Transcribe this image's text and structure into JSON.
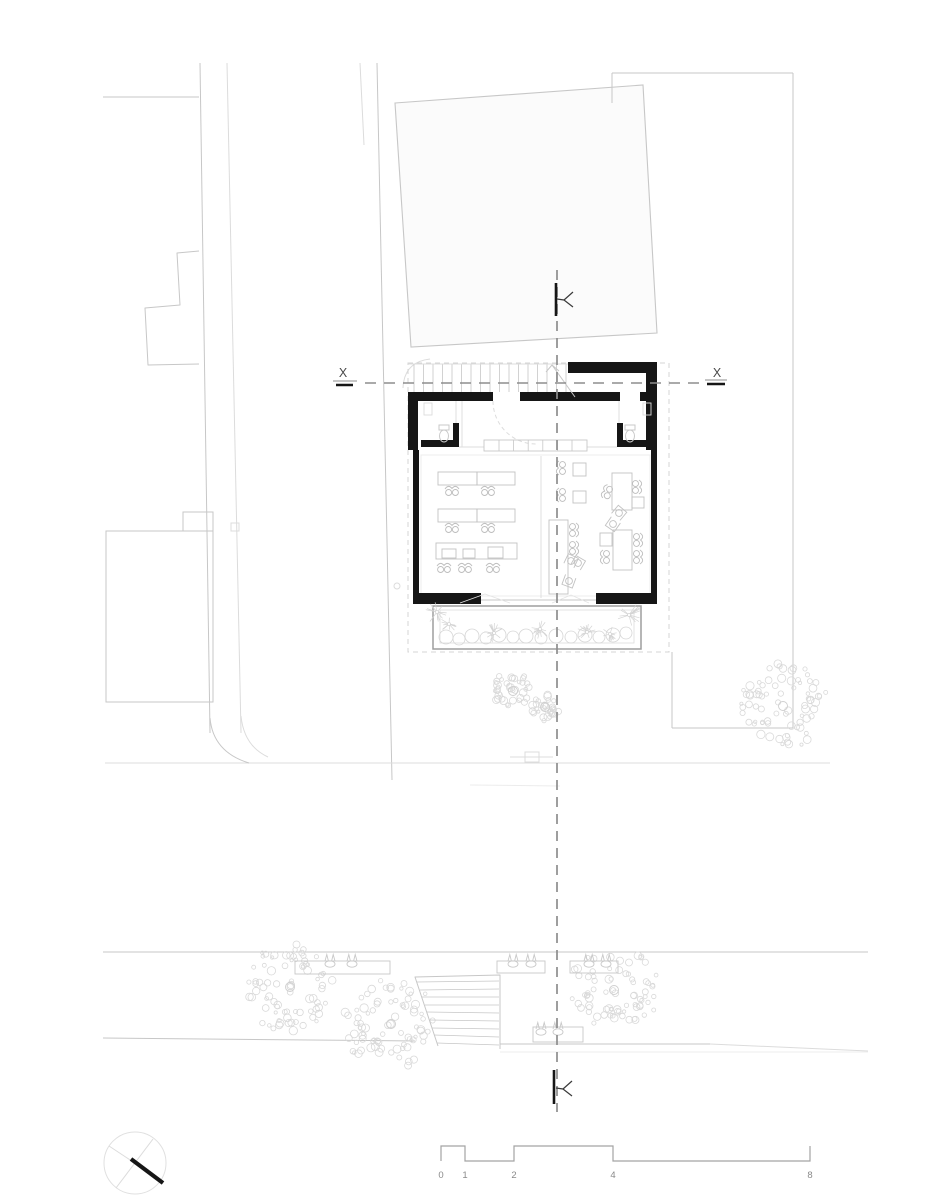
{
  "meta": {
    "title": "Ground floor site plan",
    "width": 927,
    "height": 1200
  },
  "palette": {
    "k": "#161616",
    "d": "#3a3a3a",
    "m": "#8d8d8d",
    "l": "#c7c7c7",
    "xl": "#dcdcdc",
    "f": "#ececec",
    "tree": "#d9d9d9",
    "paper": "#ffffff"
  },
  "section_labels": {
    "left": "X",
    "right": "X"
  },
  "scale_bar": {
    "labels": [
      "0",
      "1",
      "2",
      "4",
      "8"
    ],
    "xs": [
      441,
      465,
      514,
      613,
      810
    ],
    "y_top": 1146,
    "y_bot": 1161,
    "label_y": 1178,
    "stroke": "#a3a3a3",
    "text_fill": "#8a8a8a"
  },
  "texts": [
    {
      "t": "X",
      "x": 343,
      "y": 377,
      "size": 12.5,
      "fill": "#4a4a4a",
      "anchor": "middle",
      "name": "section-label-x-left"
    },
    {
      "t": "X",
      "x": 717,
      "y": 377,
      "size": 12.5,
      "fill": "#4a4a4a",
      "anchor": "middle",
      "name": "section-label-x-right"
    }
  ],
  "site_lines": [
    [
      103,
      97,
      199,
      97,
      "l",
      1
    ],
    [
      200,
      63,
      210,
      733,
      "l",
      1
    ],
    [
      227,
      63,
      241,
      733,
      "xl",
      1
    ],
    [
      360,
      63,
      364,
      145,
      "xl",
      1
    ],
    [
      377,
      63,
      392,
      780,
      "l",
      1
    ],
    [
      612,
      73,
      612,
      103,
      "l",
      1
    ],
    [
      612,
      73,
      793,
      73,
      "l",
      1
    ],
    [
      793,
      73,
      793,
      728,
      "l",
      1
    ],
    [
      793,
      728,
      672,
      728,
      "l",
      1
    ],
    [
      672,
      728,
      672,
      652,
      "l",
      1
    ],
    [
      105,
      763,
      830,
      763,
      "xl",
      1
    ],
    [
      470,
      785,
      560,
      786,
      "f",
      1
    ],
    [
      103,
      952,
      868,
      952,
      "l",
      1
    ],
    [
      103,
      1038,
      415,
      1041,
      "l",
      1
    ],
    [
      500,
      1044,
      710,
      1044,
      "l",
      1
    ],
    [
      710,
      1044,
      868,
      1051,
      "xl",
      1
    ],
    [
      500,
      1052,
      868,
      1052,
      "f",
      1
    ],
    [
      510,
      757,
      553,
      757,
      "xl",
      1
    ]
  ],
  "site_curves": [
    {
      "d": "M210,718 Q213,752 249,763",
      "s": "l",
      "w": 1
    },
    {
      "d": "M241,716 Q244,746 268,757",
      "s": "xl",
      "w": 1
    },
    {
      "d": "M403,388 Q404,362 430,359",
      "s": "xl",
      "w": 1
    }
  ],
  "site_polylines": [
    {
      "pts": [
        [
          199,
          251
        ],
        [
          177,
          253
        ],
        [
          180,
          305
        ],
        [
          145,
          308
        ],
        [
          148,
          365
        ],
        [
          199,
          364
        ]
      ],
      "s": "l",
      "w": 1
    }
  ],
  "site_polygons": [
    {
      "pts": [
        [
          395,
          103
        ],
        [
          643,
          85
        ],
        [
          657,
          333
        ],
        [
          411,
          347
        ]
      ],
      "fill": "#fbfbfb",
      "s": "l",
      "w": 1.1
    }
  ],
  "site_rects": [
    {
      "x": 106,
      "y": 531,
      "w": 107,
      "h": 171,
      "s": "l",
      "w2": 1
    },
    {
      "x": 183,
      "y": 512,
      "w": 30,
      "h": 19,
      "s": "l",
      "w2": 1
    },
    {
      "x": 231,
      "y": 523,
      "w": 8,
      "h": 8,
      "s": "xl",
      "w2": 1
    },
    {
      "x": 525,
      "y": 752,
      "w": 14,
      "h": 10,
      "s": "xl",
      "w2": 1
    }
  ],
  "site_circles": [
    {
      "cx": 397,
      "cy": 586,
      "r": 3,
      "s": "xl"
    }
  ],
  "roof_dashed": {
    "x": 408,
    "y": 363,
    "w": 261,
    "h": 289,
    "s": "#d4d4d4",
    "w2": 1,
    "dash": "5 4"
  },
  "walls": [
    {
      "x": 568,
      "y": 362,
      "w": 89,
      "h": 11
    },
    {
      "x": 646,
      "y": 373,
      "w": 11,
      "h": 77
    },
    {
      "x": 408,
      "y": 392,
      "w": 10,
      "h": 58
    },
    {
      "x": 408,
      "y": 392,
      "w": 85,
      "h": 9
    },
    {
      "x": 520,
      "y": 392,
      "w": 100,
      "h": 9
    },
    {
      "x": 640,
      "y": 392,
      "w": 17,
      "h": 9
    },
    {
      "x": 421,
      "y": 440,
      "w": 38,
      "h": 7
    },
    {
      "x": 453,
      "y": 423,
      "w": 6,
      "h": 24
    },
    {
      "x": 617,
      "y": 423,
      "w": 6,
      "h": 24
    },
    {
      "x": 617,
      "y": 440,
      "w": 33,
      "h": 7
    },
    {
      "x": 413,
      "y": 450,
      "w": 6,
      "h": 154
    },
    {
      "x": 651,
      "y": 450,
      "w": 6,
      "h": 154
    },
    {
      "x": 413,
      "y": 593,
      "w": 68,
      "h": 11
    },
    {
      "x": 596,
      "y": 593,
      "w": 61,
      "h": 11
    }
  ],
  "interior_lines": [
    [
      408,
      364,
      568,
      364,
      "xl",
      0.9
    ],
    [
      456,
      401,
      456,
      423,
      "xl",
      0.9
    ],
    [
      462,
      401,
      462,
      447,
      "xl",
      0.9
    ],
    [
      459,
      447,
      484,
      447,
      "xl",
      0.9
    ],
    [
      619,
      401,
      619,
      423,
      "xl",
      0.9
    ],
    [
      587,
      447,
      617,
      447,
      "xl",
      0.9
    ],
    [
      541,
      456,
      541,
      598,
      "xl",
      0.9
    ],
    [
      481,
      600,
      596,
      600,
      "l",
      1
    ],
    [
      575,
      397,
      552,
      365,
      "l",
      1
    ]
  ],
  "interior_polylines": [
    {
      "pts": [
        [
          546,
          372
        ],
        [
          552,
          365
        ],
        [
          559,
          371
        ]
      ],
      "s": "l",
      "w": 1
    },
    {
      "pts": [
        [
          460,
          603
        ],
        [
          485,
          594
        ],
        [
          510,
          603
        ]
      ],
      "s": "#e4e4e4",
      "w": 0.8
    },
    {
      "pts": [
        [
          552,
          603
        ],
        [
          571,
          595
        ],
        [
          589,
          603
        ]
      ],
      "s": "#e4e4e4",
      "w": 0.8
    }
  ],
  "door_arc": {
    "d": "M493,401 A43 43 0 0 0 536,444",
    "s": "xl",
    "w": 1,
    "dash": "4 3"
  },
  "stair_treads": {
    "x1": 414,
    "x2": 566,
    "n": 17,
    "y1": 364,
    "y2": 392,
    "s": "l",
    "w": 0.8
  },
  "counter": {
    "x": 484,
    "y": 440,
    "w": 103,
    "h": 11,
    "s": "l",
    "w2": 0.9,
    "dividers": {
      "x1": 499,
      "x2": 572,
      "n": 6,
      "y1": 440,
      "y2": 451,
      "s": "l",
      "w": 0.8
    }
  },
  "hall_inner_rect": {
    "x": 421,
    "y": 455,
    "w": 229,
    "h": 141,
    "s": "f",
    "w2": 1
  },
  "fixtures": {
    "toilets": [
      {
        "cx": 444,
        "cy": 436
      },
      {
        "cx": 630,
        "cy": 436
      }
    ],
    "sinks": [
      {
        "x": 424,
        "y": 403,
        "w": 8,
        "h": 12
      },
      {
        "x": 643,
        "y": 403,
        "w": 8,
        "h": 12
      }
    ]
  },
  "furniture": {
    "tables": [
      {
        "x": 438,
        "y": 472,
        "w": 39,
        "h": 13
      },
      {
        "x": 477,
        "y": 472,
        "w": 38,
        "h": 13
      },
      {
        "x": 438,
        "y": 509,
        "w": 39,
        "h": 13
      },
      {
        "x": 477,
        "y": 509,
        "w": 38,
        "h": 13
      },
      {
        "x": 436,
        "y": 543,
        "w": 81,
        "h": 16
      },
      {
        "x": 549,
        "y": 520,
        "w": 19,
        "h": 74
      },
      {
        "x": 612,
        "y": 473,
        "w": 20,
        "h": 37
      },
      {
        "x": 613,
        "y": 530,
        "w": 19,
        "h": 40
      }
    ],
    "squares": [
      {
        "x": 573,
        "y": 463,
        "w": 13,
        "h": 13
      },
      {
        "x": 573,
        "y": 491,
        "w": 13,
        "h": 12
      },
      {
        "x": 442,
        "y": 549,
        "w": 14,
        "h": 9
      },
      {
        "x": 463,
        "y": 549,
        "w": 12,
        "h": 9
      },
      {
        "x": 488,
        "y": 547,
        "w": 15,
        "h": 11
      },
      {
        "x": 632,
        "y": 497,
        "w": 12,
        "h": 11
      },
      {
        "x": 600,
        "y": 533,
        "w": 12,
        "h": 13
      }
    ],
    "chairs2": [
      {
        "x": 452,
        "y": 491,
        "r": 0
      },
      {
        "x": 488,
        "y": 491,
        "r": 0
      },
      {
        "x": 452,
        "y": 528,
        "r": 0
      },
      {
        "x": 488,
        "y": 528,
        "r": 0
      },
      {
        "x": 444,
        "y": 568,
        "r": 0
      },
      {
        "x": 465,
        "y": 568,
        "r": 0
      },
      {
        "x": 493,
        "y": 568,
        "r": 0
      },
      {
        "x": 561,
        "y": 468,
        "r": -90
      },
      {
        "x": 561,
        "y": 495,
        "r": -90
      },
      {
        "x": 574,
        "y": 530,
        "r": 90
      },
      {
        "x": 574,
        "y": 548,
        "r": 90
      },
      {
        "x": 637,
        "y": 487,
        "r": 90
      },
      {
        "x": 607,
        "y": 492,
        "r": -70
      },
      {
        "x": 638,
        "y": 540,
        "r": 90
      },
      {
        "x": 638,
        "y": 557,
        "r": 90
      },
      {
        "x": 605,
        "y": 557,
        "r": -90
      }
    ],
    "chairs1": [
      {
        "x": 619,
        "y": 513,
        "r": 40
      },
      {
        "x": 613,
        "y": 524,
        "r": 215
      },
      {
        "x": 578,
        "y": 563,
        "r": 30
      },
      {
        "x": 571,
        "y": 561,
        "r": 25
      },
      {
        "x": 569,
        "y": 581,
        "r": 200
      }
    ]
  },
  "planter": {
    "outer": {
      "x": 433,
      "y": 606,
      "w": 208,
      "h": 43,
      "s": "#9e9e9e",
      "w2": 1.5
    },
    "inner": {
      "x": 440,
      "y": 610,
      "w": 194,
      "h": 33,
      "s": "xl",
      "w2": 0.8
    },
    "bushes": [
      [
        446,
        637,
        7
      ],
      [
        459,
        639,
        6
      ],
      [
        472,
        636,
        7
      ],
      [
        486,
        638,
        6
      ],
      [
        499,
        635,
        7
      ],
      [
        513,
        637,
        6
      ],
      [
        526,
        636,
        7
      ],
      [
        541,
        638,
        6
      ],
      [
        556,
        636,
        7
      ],
      [
        571,
        637,
        6
      ],
      [
        585,
        635,
        7
      ],
      [
        599,
        637,
        6
      ],
      [
        613,
        635,
        7
      ],
      [
        626,
        633,
        6
      ]
    ],
    "stars": [
      [
        437,
        612,
        12
      ],
      [
        449,
        624,
        9
      ],
      [
        494,
        633,
        10
      ],
      [
        540,
        629,
        10
      ],
      [
        587,
        632,
        10
      ],
      [
        629,
        615,
        13
      ],
      [
        610,
        634,
        8
      ]
    ]
  },
  "trees": [
    {
      "cx": 513,
      "cy": 691,
      "r": 21,
      "seed": 11
    },
    {
      "cx": 545,
      "cy": 707,
      "r": 16,
      "seed": 22
    },
    {
      "cx": 783,
      "cy": 706,
      "r": 45,
      "seed": 33
    },
    {
      "cx": 290,
      "cy": 987,
      "r": 47,
      "seed": 44
    },
    {
      "cx": 391,
      "cy": 1024,
      "r": 48,
      "seed": 55
    },
    {
      "cx": 614,
      "cy": 990,
      "r": 45,
      "seed": 66
    }
  ],
  "benches": [
    {
      "x": 295,
      "y": 961,
      "w": 95,
      "h": 13
    },
    {
      "x": 497,
      "y": 961,
      "w": 48,
      "h": 12
    },
    {
      "x": 570,
      "y": 961,
      "w": 48,
      "h": 12
    },
    {
      "x": 533,
      "y": 1027,
      "w": 50,
      "h": 15
    }
  ],
  "pots": [
    [
      330,
      963
    ],
    [
      352,
      963
    ],
    [
      513,
      963
    ],
    [
      531,
      963
    ],
    [
      589,
      963
    ],
    [
      606,
      963
    ],
    [
      541,
      1031
    ],
    [
      558,
      1031
    ]
  ],
  "street_stairs": {
    "edges": {
      "pts": [
        [
          438,
          1046
        ],
        [
          415,
          977
        ],
        [
          500,
          975
        ],
        [
          500,
          1049
        ]
      ],
      "s": "l",
      "w": 1
    },
    "treads": [
      [
        417,
        982,
        499,
        981
      ],
      [
        420,
        990,
        499,
        989
      ],
      [
        422,
        997,
        499,
        997
      ],
      [
        425,
        1005,
        499,
        1005
      ],
      [
        427,
        1012,
        499,
        1013
      ],
      [
        430,
        1020,
        499,
        1021
      ],
      [
        432,
        1028,
        499,
        1029
      ],
      [
        434,
        1035,
        499,
        1037
      ],
      [
        437,
        1043,
        499,
        1045
      ]
    ]
  },
  "section": {
    "vline": {
      "x": 557,
      "y1": 270,
      "y2": 1112,
      "s": "m",
      "w": 1.7,
      "dash": "10 7"
    },
    "hline": {
      "y": 383,
      "x1": 365,
      "x2": 700,
      "s": "m",
      "w": 1.5,
      "dash": "11 8"
    },
    "underlines": [
      [
        333,
        381,
        357,
        381,
        "m",
        1
      ],
      [
        336,
        385,
        353,
        385,
        "k",
        2.4
      ],
      [
        705,
        380,
        727,
        380,
        "m",
        1
      ],
      [
        707,
        384,
        725,
        384,
        "k",
        2.4
      ]
    ],
    "markers": [
      {
        "tick": [
          556,
          283,
          556,
          316
        ],
        "glyph": [
          [
            573,
            292
          ],
          [
            564,
            300
          ],
          [
            573,
            307
          ]
        ],
        "tail": [
          564,
          300,
          557,
          299
        ]
      },
      {
        "tick": [
          554,
          1070,
          554,
          1104
        ],
        "glyph": [
          [
            572,
            1081
          ],
          [
            563,
            1089
          ],
          [
            572,
            1096
          ]
        ],
        "tail": [
          563,
          1089,
          556,
          1088
        ]
      }
    ]
  },
  "compass": {
    "cx": 135,
    "cy": 1163,
    "r": 31,
    "cross": [
      [
        109,
        1146,
        162,
        1181
      ],
      [
        153,
        1139,
        116,
        1188
      ]
    ],
    "needle": [
      131,
      1159,
      163,
      1183
    ]
  }
}
